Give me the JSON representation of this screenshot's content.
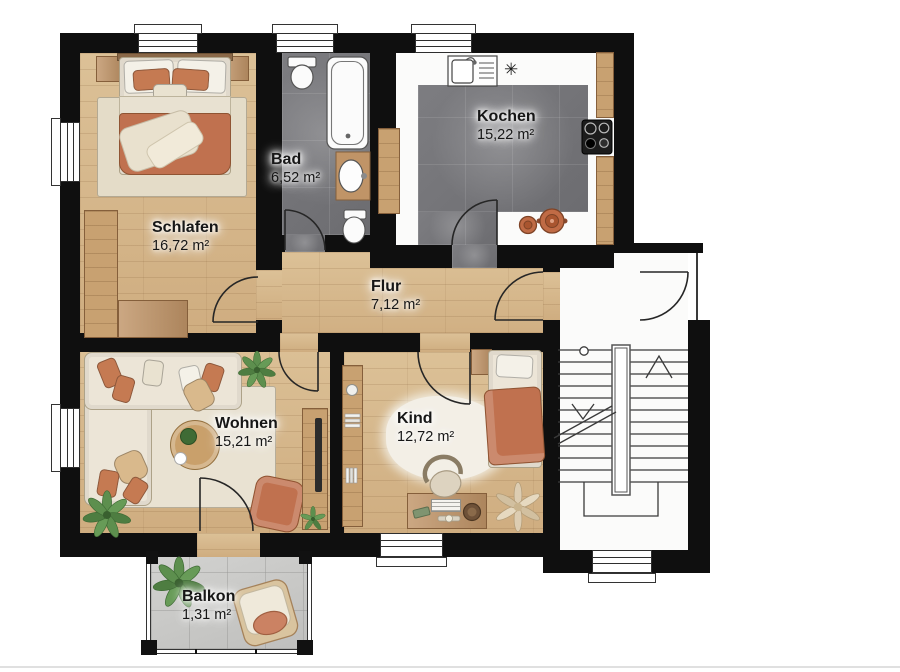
{
  "title": "Apartment floor plan",
  "rooms": [
    {
      "id": "schlafen",
      "name": "Schlafen",
      "area": "16,72 m²"
    },
    {
      "id": "bad",
      "name": "Bad",
      "area": "6,52 m²"
    },
    {
      "id": "kochen",
      "name": "Kochen",
      "area": "15,22 m²"
    },
    {
      "id": "flur",
      "name": "Flur",
      "area": "7,12 m²"
    },
    {
      "id": "wohnen",
      "name": "Wohnen",
      "area": "15,21 m²"
    },
    {
      "id": "kind",
      "name": "Kind",
      "area": "12,72 m²"
    },
    {
      "id": "balkon",
      "name": "Balkon",
      "area": "1,31 m²"
    }
  ],
  "kitchen": {
    "vent_symbol": "✳"
  },
  "palette": {
    "wall": "#0f0f0f",
    "wood_floor": "#d6b78d",
    "tile_dark": "#76767a",
    "tile_light": "#c9c9c7",
    "furniture_wood": "#c09467",
    "accent_terracotta": "#c0714f",
    "cream": "#ece5d7",
    "white_fixture": "#fbfbfb",
    "plant_green": "#5d8f4e",
    "line": "#262626"
  }
}
